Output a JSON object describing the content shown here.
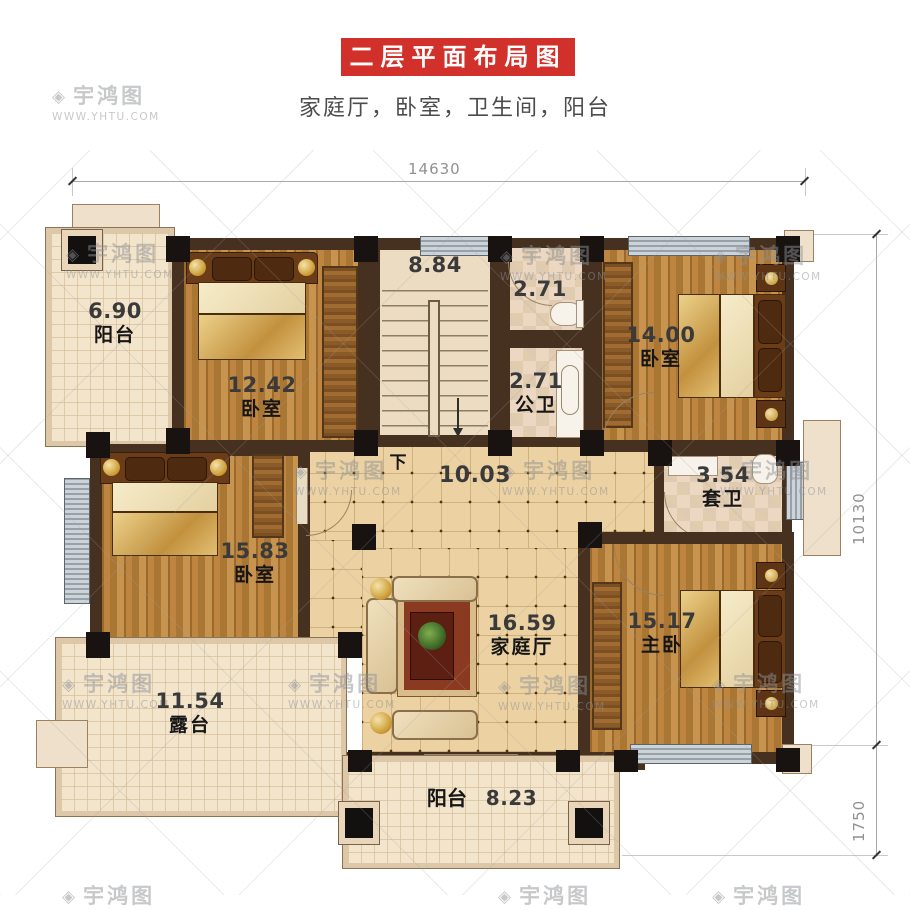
{
  "header": {
    "title": "二层平面布局图",
    "subtitle": "家庭厅，卧室，卫生间，阳台",
    "banner_color": "#d2302a"
  },
  "dimensions": {
    "top_width": "14630",
    "right_height": "10130",
    "right_balcony_depth": "1750"
  },
  "watermark": {
    "logo": "◈",
    "brand": "宇鸿图",
    "site": "WWW.YHTU.COM"
  },
  "rooms": {
    "balcony_top_left": {
      "name": "阳台",
      "area": "6.90"
    },
    "bedroom_top_left": {
      "name": "卧室",
      "area": "12.42"
    },
    "stairs": {
      "area": "8.84",
      "down_label": "下"
    },
    "bath_top": {
      "area": "2.71"
    },
    "bath_public": {
      "name": "公卫",
      "area": "2.71"
    },
    "bedroom_top_right": {
      "name": "卧室",
      "area": "14.00"
    },
    "hallway": {
      "area": "10.03"
    },
    "ensuite_bath": {
      "name": "套卫",
      "area": "3.54"
    },
    "bedroom_left": {
      "name": "卧室",
      "area": "15.83"
    },
    "family_hall": {
      "name": "家庭厅",
      "area": "16.59"
    },
    "master_bedroom": {
      "name": "主卧",
      "area": "15.17"
    },
    "terrace": {
      "name": "露台",
      "area": "11.54"
    },
    "balcony_bottom": {
      "name": "阳台",
      "area": "8.23"
    }
  },
  "colors": {
    "banner_red": "#d2302a",
    "wall_brown": "#46301f",
    "wood_floor": "#bd853f",
    "tile_floor": "#ecd2a2",
    "balcony_floor": "#f3e4cc",
    "window_gray": "#aeb6bd",
    "dimension_gray": "#909090"
  }
}
